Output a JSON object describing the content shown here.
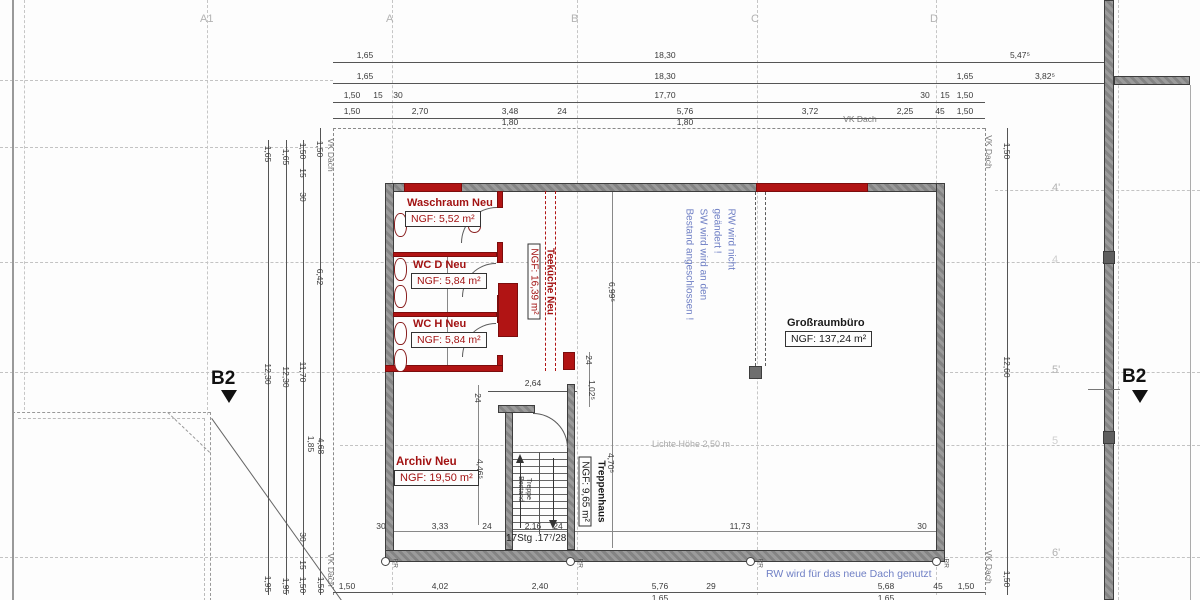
{
  "grid": {
    "cols": [
      "A1",
      "A",
      "B",
      "C",
      "D"
    ],
    "rows": [
      "4'",
      "4",
      "5'",
      "5",
      "6'"
    ],
    "section_marker": "B2"
  },
  "rooms": {
    "waschraum": {
      "name": "Waschraum Neu",
      "ngf": "NGF:   5,52 m²"
    },
    "wc_d": {
      "name": "WC D Neu",
      "ngf": "NGF: 5,84 m²"
    },
    "wc_h": {
      "name": "WC H Neu",
      "ngf": "NGF: 5,84 m²"
    },
    "teekueche": {
      "name": "Teeküche Neu",
      "ngf": "NGF: 16,39 m²"
    },
    "grossraumbuero": {
      "name": "Großraumbüro",
      "ngf": "NGF: 137,24 m²"
    },
    "archiv": {
      "name": "Archiv Neu",
      "ngf": "NGF: 19,50 m²"
    },
    "treppenhaus": {
      "name": "Treppenhaus",
      "ngf": "NGF: 9,65 m²"
    }
  },
  "notes": {
    "blue_lines": [
      "RW wird nicht",
      "geändert !",
      "SW wird wird an den",
      "Bestand angeschlossen !"
    ],
    "blue_bottom": "RW wird für das neue Dach genutzt",
    "lichte_hoehe": "Lichte Höhe 2,50 m"
  },
  "stair": {
    "label": "17Stg .17⁷/28",
    "lines": [
      "Treppe",
      "Bestand"
    ]
  },
  "misc": {
    "vk_dach": "VK Dach",
    "rr": "RR"
  },
  "dims": {
    "top1": [
      "1,65",
      "18,30",
      "5,47⁵"
    ],
    "top2": [
      "1,65",
      "18,30",
      "1,65",
      "3,82⁵"
    ],
    "top3": [
      "1,50",
      "15",
      "30",
      "17,70",
      "30",
      "15",
      "1,50"
    ],
    "top4": [
      "1,50",
      "2,70",
      "3,48",
      "24",
      "5,76",
      "3,72",
      "2,25",
      "45",
      "1,50"
    ],
    "top4b": [
      "1,80",
      "1,80"
    ],
    "left1": [
      "1,65",
      "12,30",
      "1,95"
    ],
    "left2": [
      "1,65",
      "12,30",
      "1,95"
    ],
    "left3": [
      "1,50",
      "15",
      "30",
      "11,70",
      "30",
      "15",
      "1,50"
    ],
    "left4": [
      "1,50",
      "6,42",
      "1,85",
      "4,68",
      "1,50"
    ],
    "right1": [
      "1,50",
      "12,60",
      "1,50"
    ],
    "bottom1": [
      "1,50",
      "4,02",
      "2,40",
      "5,76",
      "29",
      "5,68",
      "45",
      "1,50"
    ],
    "bottom2": [
      "1,65",
      "1,65"
    ],
    "stair_row": [
      "30",
      "3,33",
      "24",
      "2,16",
      "24",
      "11,73",
      "30"
    ],
    "mid": [
      "2,64",
      "24",
      "1,02⁵",
      "6,99⁵",
      "4,70⁵",
      "24",
      "4,46⁵"
    ]
  }
}
